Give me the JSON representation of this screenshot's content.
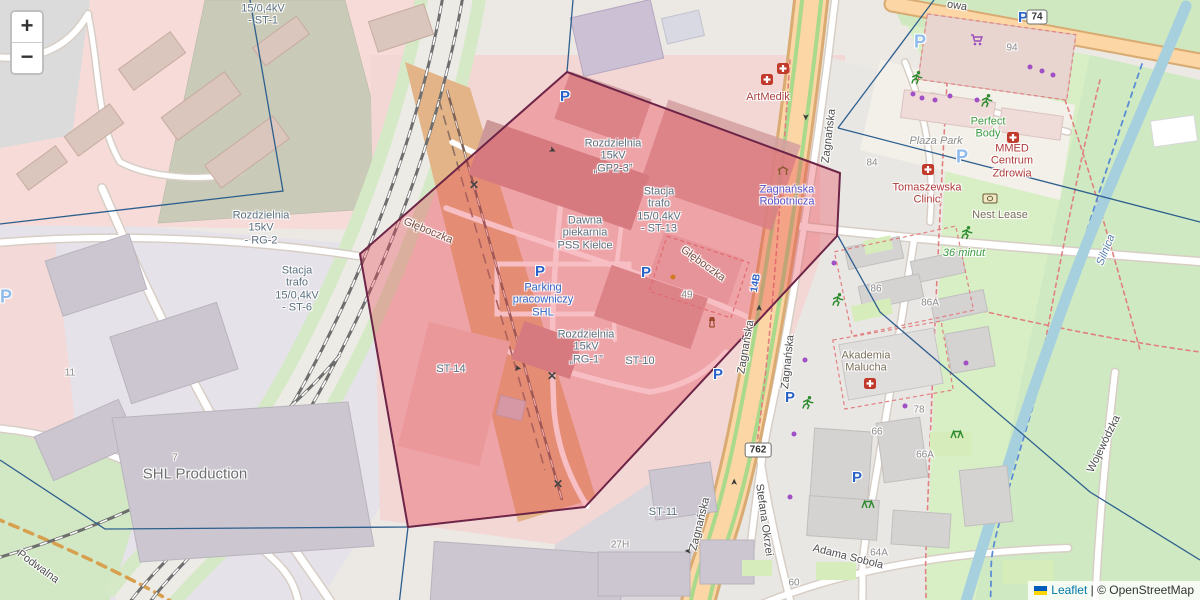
{
  "map": {
    "zoom_controls": {
      "zoom_in": "+",
      "zoom_out": "−"
    },
    "attribution": {
      "flag": "ukraine-flag",
      "leaflet": "Leaflet",
      "sep": "|",
      "copyright": "© OpenStreetMap"
    },
    "colors": {
      "highlight_fill": "#e8404f",
      "highlight_stroke": "#6d2547",
      "boundary": "#2d5f8e",
      "road_primary": "#fcd6a4",
      "water": "#a6d0de",
      "park": "#d8efc6",
      "leaflet_link": "#0078A8",
      "copyright_text": "#333333",
      "flag_blue": "#005bbb",
      "flag_yellow": "#ffd500"
    },
    "overlay": {
      "polygon_points": "567,72 840,173 837,236 585,507 408,527 360,254",
      "boundaries": [
        "0,224 283,191 250,0",
        "573,0 567,72",
        "934,0 838,128",
        "838,128 1200,222",
        "838,236 880,312 1090,492 1200,560",
        "0,460 105,529 408,527",
        "408,527 399,605"
      ]
    },
    "route_shields": [
      {
        "t": "762",
        "x": 758,
        "y": 450
      },
      {
        "t": "74",
        "x": 1037,
        "y": 17
      }
    ],
    "labels": [
      {
        "t": "15/0,4kV\n- ST-1",
        "x": 263,
        "y": 15,
        "c": "#5c7180"
      },
      {
        "t": "Rozdzielnia\n15kV\n- RG-2",
        "x": 261,
        "y": 228,
        "c": "#5c7180"
      },
      {
        "t": "Stacja\ntrafo\n15/0,4kV\n- ST-6",
        "x": 297,
        "y": 289,
        "c": "#5c7180"
      },
      {
        "t": "Rozdzielnia\n15kV\n„GP2-3”",
        "x": 613,
        "y": 156,
        "c": "#5c7180"
      },
      {
        "t": "Stacja\ntrafo\n15/0,4kV\n- ST-13",
        "x": 659,
        "y": 210,
        "c": "#5c7180"
      },
      {
        "t": "Dawna\npiekarnia\nPSS Kielce",
        "x": 585,
        "y": 233,
        "c": "#5c7180"
      },
      {
        "t": "Rozdzielnia\n15kV\n„RG-1”",
        "x": 586,
        "y": 347,
        "c": "#5c7180"
      },
      {
        "t": "ST-10",
        "x": 640,
        "y": 361,
        "c": "#5c7180"
      },
      {
        "t": "ST-14",
        "x": 451,
        "y": 369,
        "c": "#5c7180"
      },
      {
        "t": "ST-11",
        "x": 663,
        "y": 512,
        "c": "#5c7180"
      },
      {
        "t": "Parking\npracowniczy\nSHL",
        "x": 543,
        "y": 300,
        "c": "#2f62c4"
      },
      {
        "t": "SHL Production",
        "x": 195,
        "y": 475,
        "c": "#6e6e6e",
        "s": 15
      },
      {
        "t": "Głęboczka",
        "x": 428,
        "y": 231,
        "c": "#7d5146",
        "r": 22
      },
      {
        "t": "Głęboczka",
        "x": 703,
        "y": 264,
        "c": "#7d5146",
        "r": 36
      },
      {
        "t": "Zagnańska",
        "x": 829,
        "y": 136,
        "c": "#4e4e4e",
        "r": -83
      },
      {
        "t": "Zagnańska",
        "x": 746,
        "y": 347,
        "c": "#4e4e4e",
        "r": -80
      },
      {
        "t": "Zagnańska",
        "x": 788,
        "y": 362,
        "c": "#4e4e4e",
        "r": -84
      },
      {
        "t": "Zagnańska",
        "x": 700,
        "y": 524,
        "c": "#4e4e4e",
        "r": -76
      },
      {
        "t": "Stefana Okrzei",
        "x": 764,
        "y": 520,
        "c": "#4e4e4e",
        "r": 82
      },
      {
        "t": "Adama Sobola",
        "x": 848,
        "y": 557,
        "c": "#4e4e4e",
        "r": 14
      },
      {
        "t": "Wojewódzka",
        "x": 1104,
        "y": 444,
        "c": "#4e4e4e",
        "r": -64
      },
      {
        "t": "Podwalna",
        "x": 38,
        "y": 567,
        "c": "#4e4e4e",
        "r": 36
      },
      {
        "t": "owa",
        "x": 957,
        "y": 6,
        "c": "#4e4e4e",
        "r": 9
      },
      {
        "t": "Zagnańska\nRobotnicza",
        "x": 787,
        "y": 196,
        "c": "#5a50c8"
      },
      {
        "t": "14B",
        "x": 756,
        "y": 283,
        "c": "#2f62c4",
        "r": -80,
        "s": 10,
        "b": 1
      },
      {
        "t": "ArtMedik",
        "x": 768,
        "y": 97,
        "c": "#ab4343"
      },
      {
        "t": "Plaza Park",
        "x": 936,
        "y": 141,
        "c": "#8a8a8a",
        "i": 1
      },
      {
        "t": "Perfect\nBody",
        "x": 988,
        "y": 128,
        "c": "#3d9b42"
      },
      {
        "t": "MMED\nCentrum\nZdrowia",
        "x": 1012,
        "y": 161,
        "c": "#b03a3a"
      },
      {
        "t": "Tomaszewska\nClinic",
        "x": 927,
        "y": 194,
        "c": "#b03a3a"
      },
      {
        "t": "Nest Lease",
        "x": 1000,
        "y": 215,
        "c": "#7a6f5a"
      },
      {
        "t": "36 minut",
        "x": 964,
        "y": 253,
        "c": "#3d9b42",
        "i": 1
      },
      {
        "t": "Akademia\nMalucha",
        "x": 866,
        "y": 362,
        "c": "#7a6f5a"
      },
      {
        "t": "Silnica",
        "x": 1106,
        "y": 250,
        "c": "#5a7fae",
        "i": 1,
        "r": -68
      },
      {
        "t": "94",
        "x": 1012,
        "y": 48,
        "c": "#8a8a8a",
        "s": 10
      },
      {
        "t": "84",
        "x": 872,
        "y": 163,
        "c": "#8a8a8a",
        "s": 10
      },
      {
        "t": "86",
        "x": 876,
        "y": 289,
        "c": "#8a8a8a",
        "s": 10
      },
      {
        "t": "86A",
        "x": 930,
        "y": 303,
        "c": "#8a8a8a",
        "s": 10
      },
      {
        "t": "78",
        "x": 919,
        "y": 410,
        "c": "#8a8a8a",
        "s": 10
      },
      {
        "t": "66",
        "x": 877,
        "y": 432,
        "c": "#8a8a8a",
        "s": 10
      },
      {
        "t": "66A",
        "x": 925,
        "y": 455,
        "c": "#8a8a8a",
        "s": 10
      },
      {
        "t": "64A",
        "x": 879,
        "y": 553,
        "c": "#8a8a8a",
        "s": 10
      },
      {
        "t": "60",
        "x": 794,
        "y": 583,
        "c": "#8a8a8a",
        "s": 10
      },
      {
        "t": "49",
        "x": 687,
        "y": 295,
        "c": "#8a8a8a",
        "s": 10
      },
      {
        "t": "11",
        "x": 70,
        "y": 373,
        "c": "#8a8a8a",
        "s": 10
      },
      {
        "t": "7",
        "x": 175,
        "y": 458,
        "c": "#8a8a8a",
        "s": 10
      },
      {
        "t": "27H",
        "x": 620,
        "y": 545,
        "c": "#8a8a8a",
        "s": 10
      }
    ],
    "icons": [
      {
        "t": "parking",
        "x": 565,
        "y": 97
      },
      {
        "t": "parking",
        "x": 540,
        "y": 272
      },
      {
        "t": "parking",
        "x": 646,
        "y": 273
      },
      {
        "t": "parking",
        "x": 718,
        "y": 375
      },
      {
        "t": "parking",
        "x": 790,
        "y": 398
      },
      {
        "t": "parking",
        "x": 857,
        "y": 478
      },
      {
        "t": "parking",
        "x": 1023,
        "y": 18
      },
      {
        "t": "parking-light",
        "x": 6,
        "y": 297
      },
      {
        "t": "parking-light",
        "x": 920,
        "y": 42
      },
      {
        "t": "parking-light",
        "x": 962,
        "y": 157
      },
      {
        "t": "medical",
        "x": 767,
        "y": 82
      },
      {
        "t": "medical",
        "x": 783,
        "y": 71
      },
      {
        "t": "medical",
        "x": 928,
        "y": 172
      },
      {
        "t": "medical",
        "x": 1013,
        "y": 140
      },
      {
        "t": "medical",
        "x": 870,
        "y": 386
      },
      {
        "t": "cart",
        "x": 977,
        "y": 42
      },
      {
        "t": "money",
        "x": 990,
        "y": 200
      },
      {
        "t": "shelter",
        "x": 783,
        "y": 172
      },
      {
        "t": "tower",
        "x": 712,
        "y": 324
      },
      {
        "t": "runner",
        "x": 917,
        "y": 80
      },
      {
        "t": "runner",
        "x": 987,
        "y": 103
      },
      {
        "t": "runner",
        "x": 967,
        "y": 235
      },
      {
        "t": "runner",
        "x": 838,
        "y": 302
      },
      {
        "t": "runner",
        "x": 808,
        "y": 405
      },
      {
        "t": "playground",
        "x": 957,
        "y": 435
      },
      {
        "t": "playground",
        "x": 868,
        "y": 505
      },
      {
        "t": "tree",
        "x": 1030,
        "y": 67
      },
      {
        "t": "tree",
        "x": 1042,
        "y": 71
      },
      {
        "t": "tree",
        "x": 1053,
        "y": 75
      },
      {
        "t": "tree",
        "x": 913,
        "y": 94
      },
      {
        "t": "tree",
        "x": 922,
        "y": 98
      },
      {
        "t": "tree",
        "x": 935,
        "y": 100
      },
      {
        "t": "tree",
        "x": 950,
        "y": 96
      },
      {
        "t": "tree",
        "x": 977,
        "y": 100
      },
      {
        "t": "tree",
        "x": 834,
        "y": 263
      },
      {
        "t": "tree",
        "x": 805,
        "y": 360
      },
      {
        "t": "tree",
        "x": 966,
        "y": 363
      },
      {
        "t": "tree",
        "x": 905,
        "y": 406
      },
      {
        "t": "tree",
        "x": 794,
        "y": 434
      },
      {
        "t": "tree",
        "x": 790,
        "y": 497
      },
      {
        "t": "dot-orange",
        "x": 673,
        "y": 277
      },
      {
        "t": "crossing",
        "x": 474,
        "y": 185
      },
      {
        "t": "crossing",
        "x": 552,
        "y": 376
      },
      {
        "t": "crossing",
        "x": 558,
        "y": 484
      },
      {
        "t": "arrow",
        "x": 807,
        "y": 117,
        "r": 90
      },
      {
        "t": "arrow",
        "x": 758,
        "y": 308,
        "r": -90
      },
      {
        "t": "arrow",
        "x": 733,
        "y": 482,
        "r": -90
      },
      {
        "t": "arrow",
        "x": 688,
        "y": 552,
        "r": 180
      },
      {
        "t": "arrow",
        "x": 553,
        "y": 149,
        "r": 25
      },
      {
        "t": "arrow",
        "x": 518,
        "y": 367,
        "r": 10
      }
    ]
  }
}
